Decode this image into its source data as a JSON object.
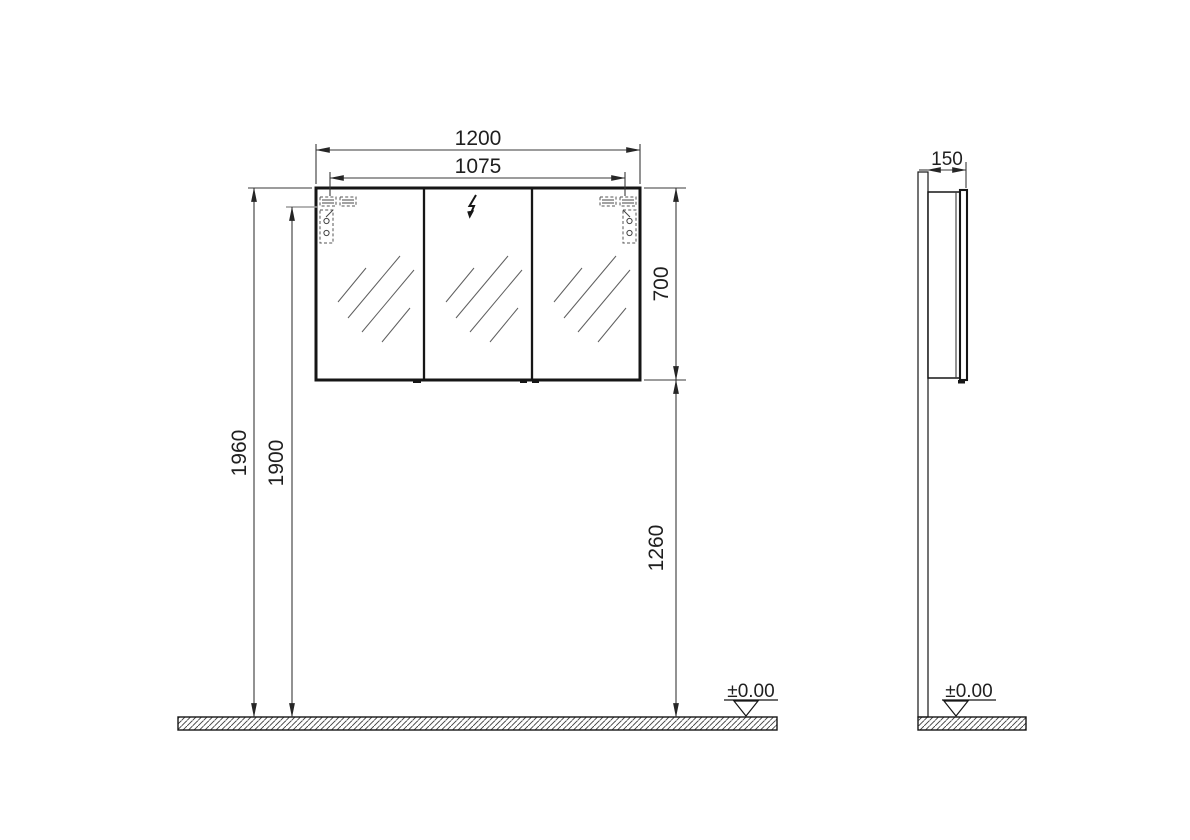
{
  "front_view": {
    "dimensions": {
      "overall_width": "1200",
      "hinge_span": "1075",
      "cabinet_height": "700",
      "overall_height": "1960",
      "hinge_height": "1900",
      "underside_clearance": "1260"
    },
    "floor_level": "±0.00"
  },
  "side_view": {
    "dimensions": {
      "depth": "150"
    },
    "floor_level": "±0.00"
  },
  "icons": {
    "power_supply": "lightning-bolt"
  },
  "colors": {
    "line": "#161616",
    "dimension_line": "#3a3a3a",
    "reference_gray": "#9c9c9c",
    "background": "#ffffff"
  }
}
